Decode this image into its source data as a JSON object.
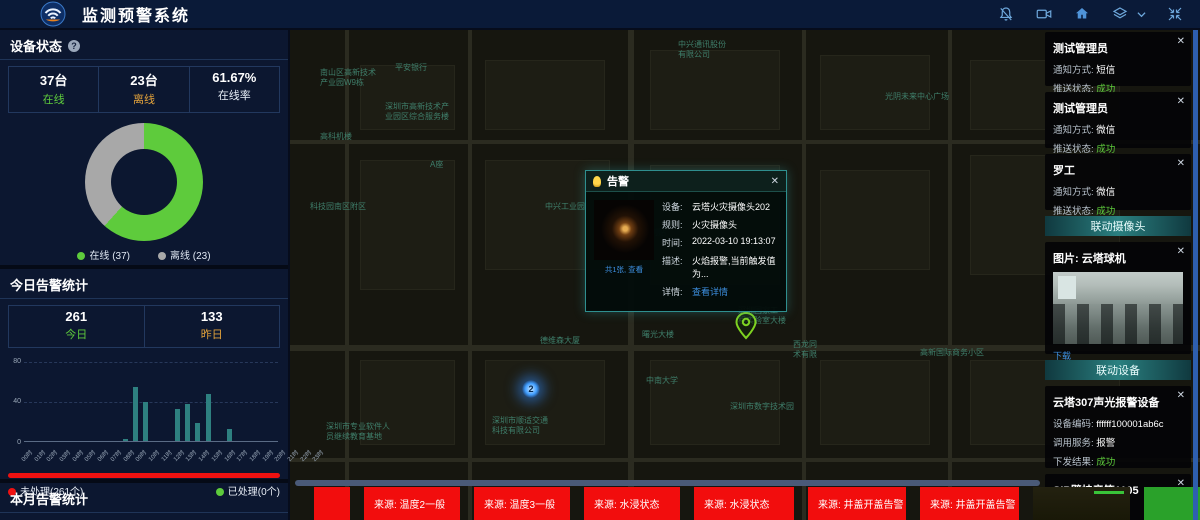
{
  "header": {
    "title": "监测预警系统"
  },
  "device_status": {
    "title": "设备状态",
    "help": "?",
    "stats": [
      {
        "value": "37台",
        "label": "在线"
      },
      {
        "value": "23台",
        "label": "离线"
      },
      {
        "value": "61.67%",
        "label": "在线率"
      }
    ],
    "legend": [
      {
        "label": "在线 (37)"
      },
      {
        "label": "离线 (23)"
      }
    ]
  },
  "today_alarms": {
    "title": "今日告警统计",
    "stats": [
      {
        "value": "261",
        "label": "今日"
      },
      {
        "value": "133",
        "label": "昨日"
      }
    ],
    "unhandled_label": "未处理(261个)",
    "handled_label": "已处理(0个)"
  },
  "month_alarms": {
    "title": "本月告警统计",
    "stats": [
      {
        "value": "763"
      },
      {
        "value": "1146"
      }
    ]
  },
  "chart_data": [
    {
      "type": "pie",
      "title": "设备状态",
      "categories": [
        "在线",
        "离线"
      ],
      "values": [
        37,
        23
      ],
      "colors": [
        "#5ecb3c",
        "#a8a8a8"
      ],
      "donut": true,
      "legend_position": "bottom"
    },
    {
      "type": "bar",
      "title": "今日告警统计(按小时)",
      "categories": [
        "00时",
        "01时",
        "02时",
        "03时",
        "04时",
        "05时",
        "06时",
        "07时",
        "08时",
        "09时",
        "10时",
        "11时",
        "12时",
        "13时",
        "14时",
        "15时",
        "16时",
        "17时",
        "18时",
        "19时",
        "20时",
        "21时",
        "22时",
        "23时"
      ],
      "values": [
        0,
        0,
        0,
        0,
        0,
        0,
        0,
        0,
        0,
        2,
        55,
        40,
        0,
        0,
        32,
        37,
        18,
        48,
        0,
        12,
        0,
        0,
        0,
        0
      ],
      "ylim": [
        0,
        80
      ],
      "yticks": [
        0,
        40,
        80
      ],
      "bar_color": "#2e8080",
      "grid": "dashed"
    }
  ],
  "map": {
    "labels": [
      {
        "text": "中兴通讯股份\n有限公司",
        "x": 388,
        "y": 10
      },
      {
        "text": "南山区高新技术\n产业园W9栋",
        "x": 30,
        "y": 38
      },
      {
        "text": "平安银行",
        "x": 105,
        "y": 33
      },
      {
        "text": "深圳市高新技术产\n业园区综合服务楼",
        "x": 95,
        "y": 72
      },
      {
        "text": "高科机楼",
        "x": 30,
        "y": 102
      },
      {
        "text": "A座",
        "x": 140,
        "y": 130
      },
      {
        "text": "科技园南区附区",
        "x": 20,
        "y": 172
      },
      {
        "text": "中兴工业园",
        "x": 255,
        "y": 172
      },
      {
        "text": "便利贴",
        "x": 352,
        "y": 198
      },
      {
        "text": "光阴未来中心广场",
        "x": 595,
        "y": 62
      },
      {
        "text": "德维森大厦",
        "x": 250,
        "y": 306
      },
      {
        "text": "曙光大楼",
        "x": 352,
        "y": 300
      },
      {
        "text": "中南大学",
        "x": 356,
        "y": 346
      },
      {
        "text": "深圳国家工\n程实验室大楼",
        "x": 448,
        "y": 276
      },
      {
        "text": "西龙同\n术有限",
        "x": 503,
        "y": 310
      },
      {
        "text": "高新国际商务小区",
        "x": 630,
        "y": 318
      },
      {
        "text": "深圳市数字技术园",
        "x": 440,
        "y": 372
      },
      {
        "text": "深圳市顺适交通\n科技有限公司",
        "x": 202,
        "y": 386
      },
      {
        "text": "深圳市专业软件人\n员继续教育基地",
        "x": 36,
        "y": 392
      }
    ],
    "cluster_marker": {
      "count": "2",
      "x": 232,
      "y": 350
    },
    "popup": {
      "title": "告警",
      "close": "✕",
      "thumb_caption": "共1张, 查看",
      "rows": [
        {
          "label": "设备:",
          "value": "云塔火灾摄像头202"
        },
        {
          "label": "规则:",
          "value": "火灾摄像头"
        },
        {
          "label": "时间:",
          "value": "2022-03-10 19:13:07"
        },
        {
          "label": "描述:",
          "value": "火焰报警,当前触发值为..."
        },
        {
          "label": "详情:",
          "value": "查看详情"
        }
      ]
    }
  },
  "notifications": [
    {
      "name": "测试管理员",
      "method_label": "通知方式:",
      "method": "短信",
      "status_label": "推送状态:",
      "status": "成功",
      "close": "✕"
    },
    {
      "name": "测试管理员",
      "method_label": "通知方式:",
      "method": "微信",
      "status_label": "推送状态:",
      "status": "成功",
      "close": "✕"
    },
    {
      "name": "罗工",
      "method_label": "通知方式:",
      "method": "微信",
      "status_label": "推送状态:",
      "status": "成功",
      "close": "✕"
    }
  ],
  "linked_camera": {
    "header": "联动摄像头",
    "image_title": "图片: 云塔球机",
    "download_label": "下载",
    "close": "✕"
  },
  "linked_devices": {
    "header": "联动设备",
    "devices": [
      {
        "name": "云塔307声光报警设备",
        "close": "✕",
        "code_label": "设备编码:",
        "code": "ffffff100001ab6c",
        "service_label": "调用服务:",
        "service": "报警",
        "result_label": "下发结果:",
        "result": "成功"
      },
      {
        "name": "SIP壁挂音箱1105",
        "close": "✕",
        "code_label": "设备编码:",
        "code": "1106"
      }
    ]
  },
  "bottom_alerts": [
    {
      "text": "",
      "w": 36
    },
    {
      "text": "来源: 温度2一般",
      "w": 96
    },
    {
      "text": "来源: 温度3一般",
      "w": 96
    },
    {
      "text": "来源: 水浸状态",
      "w": 96
    },
    {
      "text": "来源: 水浸状态",
      "w": 100
    },
    {
      "text": "来源: 井盖开盖告警",
      "w": 98
    },
    {
      "text": "来源: 井盖开盖告警",
      "w": 99
    }
  ]
}
